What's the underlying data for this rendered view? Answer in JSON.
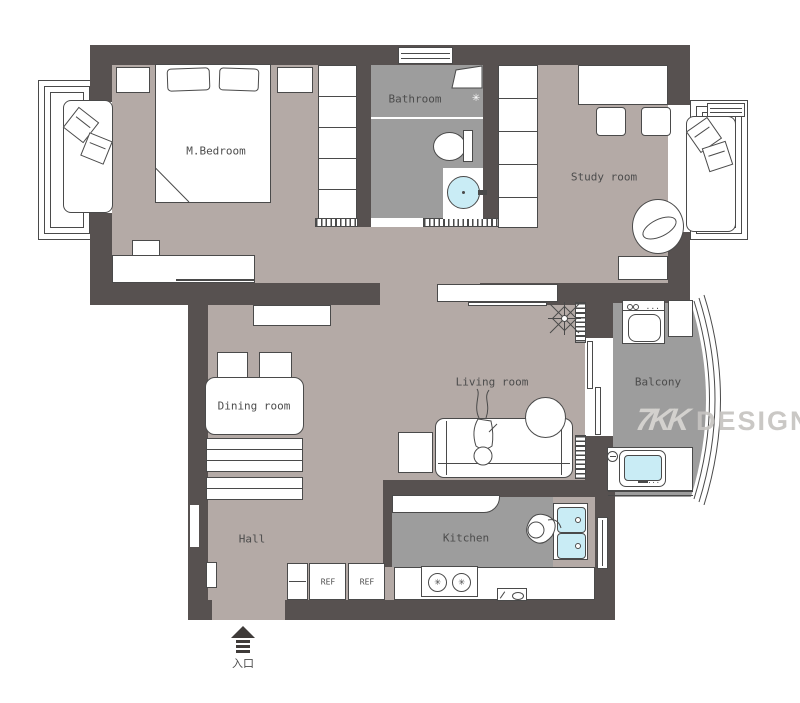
{
  "colors": {
    "wall": "#575150",
    "floor": "#b4aaa6",
    "wetfloor": "#9d9d9d",
    "water": "#c9ecf5",
    "outline": "#4a4a4a",
    "label": "#4c4c4c",
    "wmlogo": "#d8d6d3",
    "wmtext": "#c6c4c1",
    "arrow": "#3f3b39"
  },
  "rooms": {
    "bedroom": {
      "label": "M.Bedroom"
    },
    "bathroom": {
      "label": "Bathroom"
    },
    "study": {
      "label": "Study room"
    },
    "living": {
      "label": "Living room"
    },
    "dining": {
      "label": "Dining room"
    },
    "balcony": {
      "label": "Balcony"
    },
    "hall": {
      "label": "Hall"
    },
    "kitchen": {
      "label": "Kitchen"
    }
  },
  "appliances": {
    "fridge1": "REF",
    "fridge2": "REF"
  },
  "entrance": {
    "label": "入口"
  },
  "watermark": {
    "logo": "7KK",
    "text": "DESIGN"
  }
}
